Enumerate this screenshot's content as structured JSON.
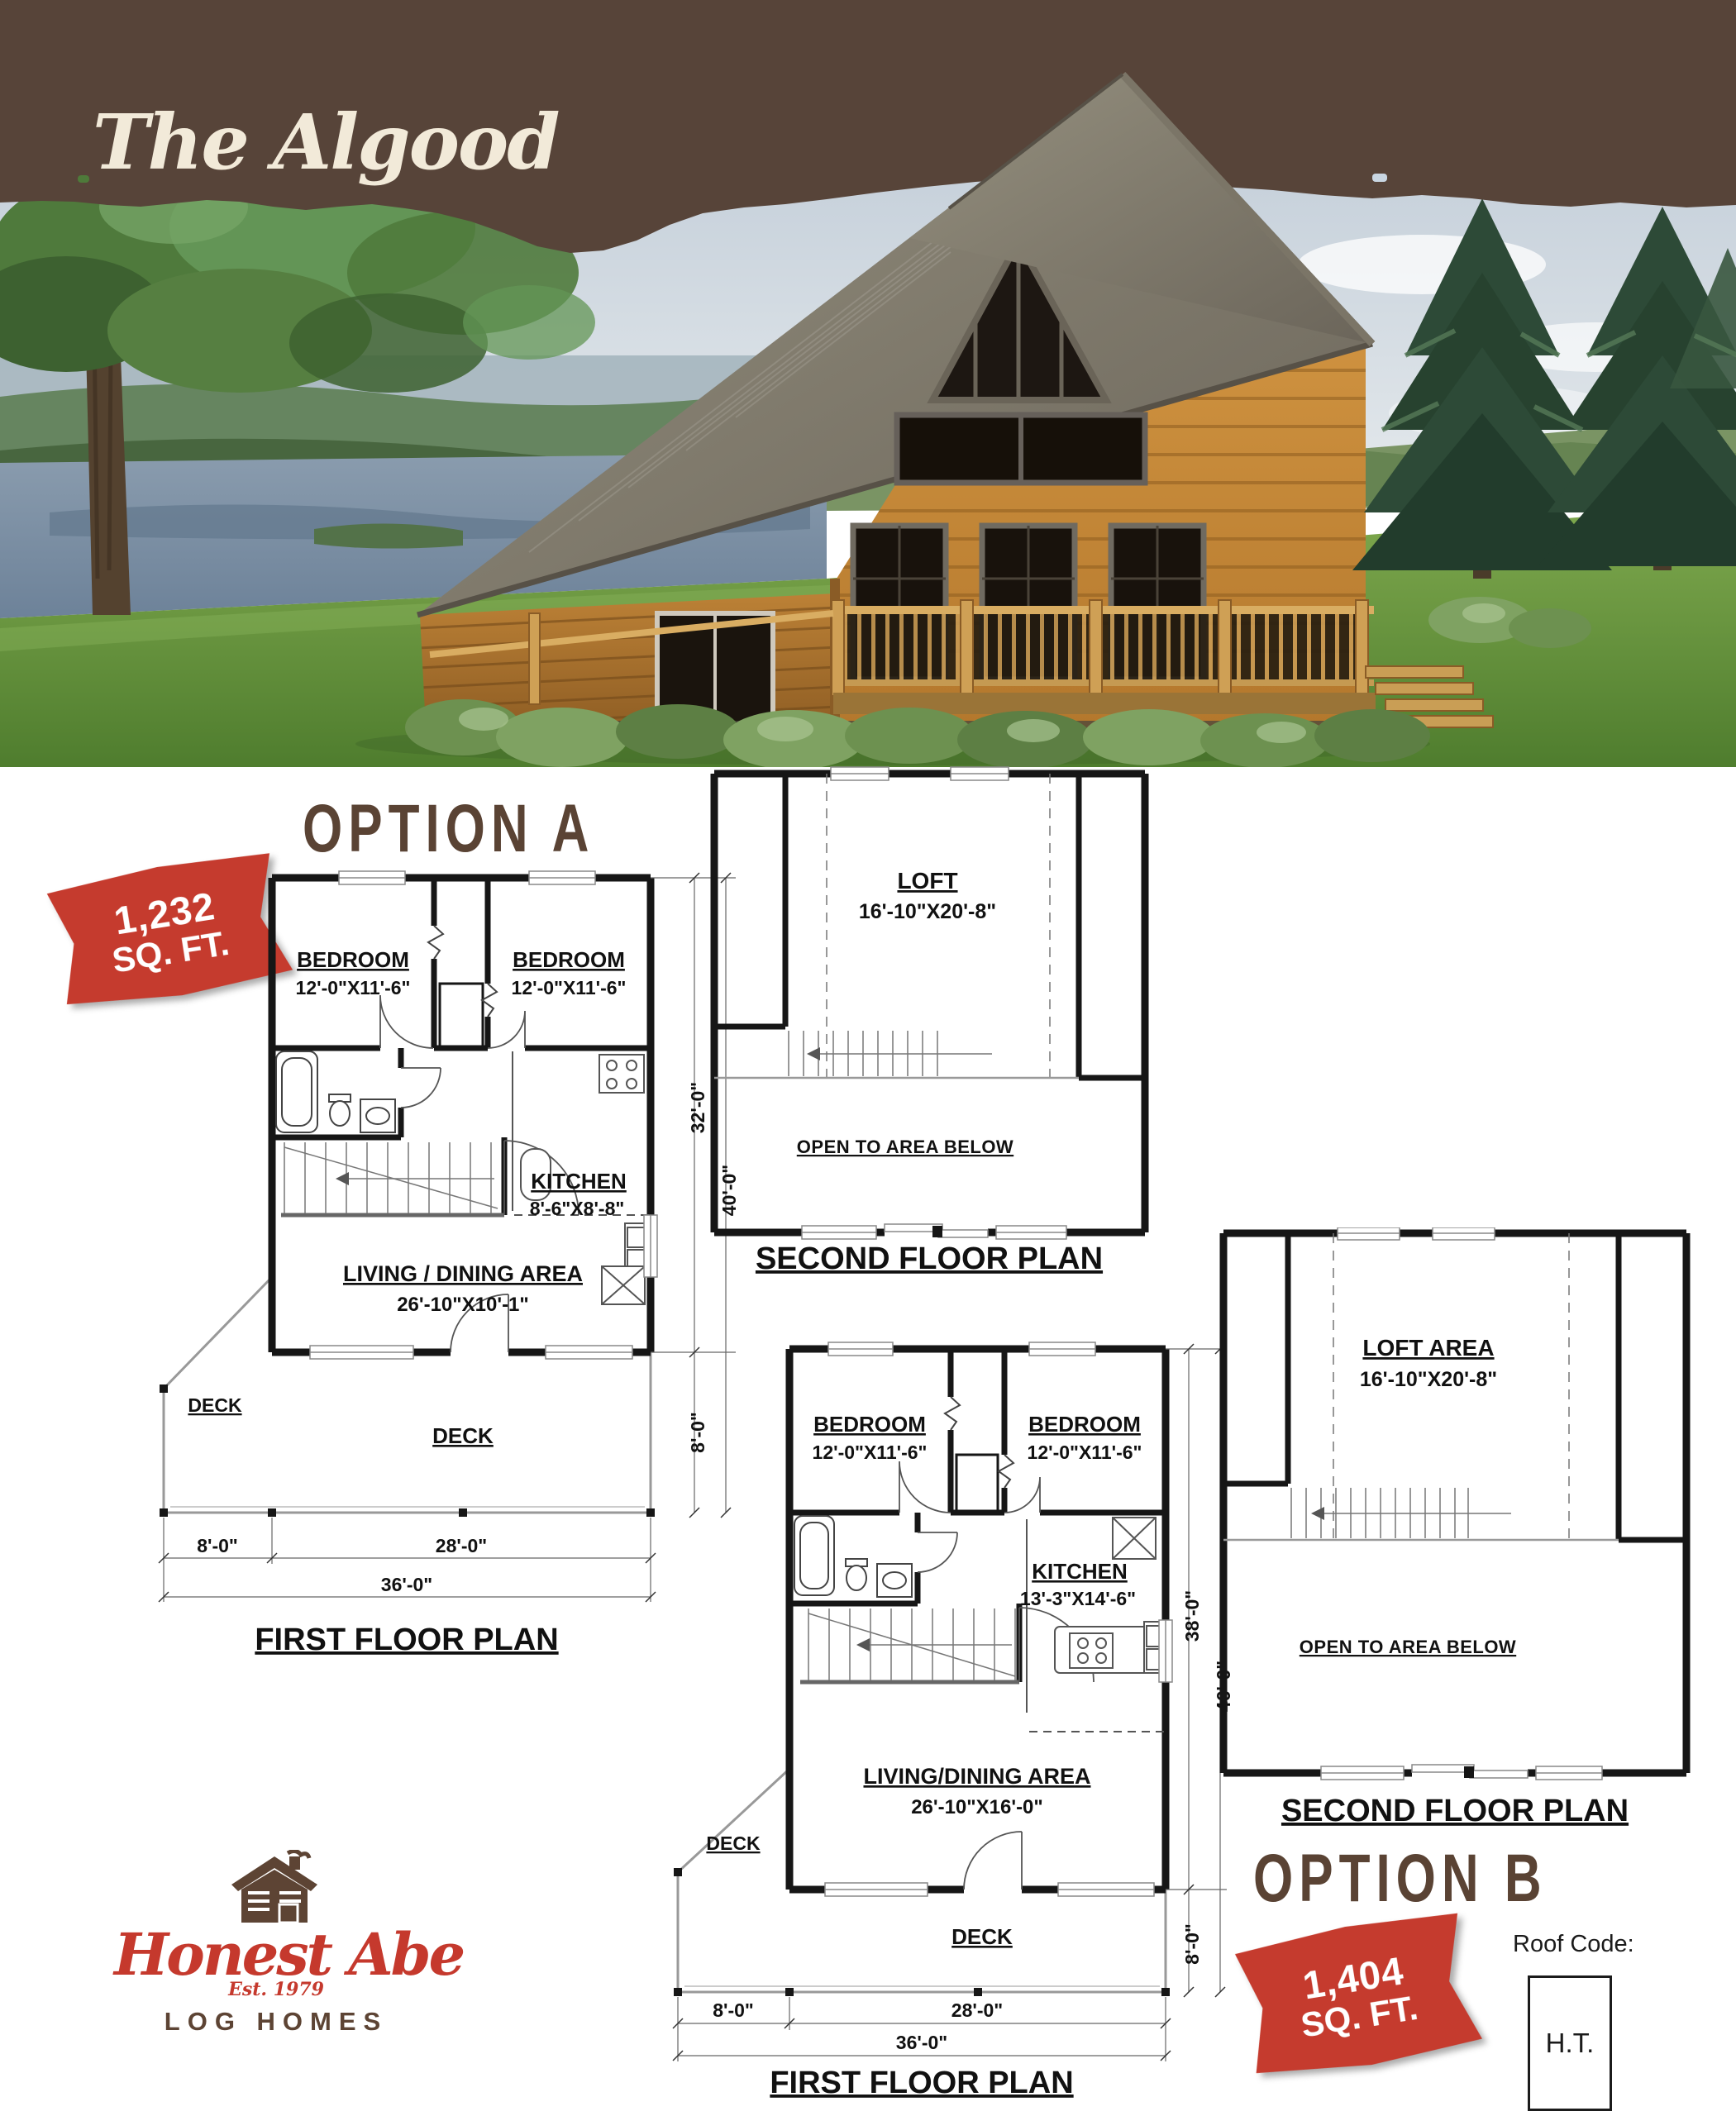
{
  "page_title": "The Algood",
  "colors": {
    "header_brown": "#574439",
    "heading_brown": "#5a4334",
    "badge_red": "#c53b2e",
    "logo_red": "#c5392d",
    "logo_brown": "#5d4434",
    "plan_line": "#161616",
    "title_cream": "#f2ead9"
  },
  "logo": {
    "name": "Honest Abe",
    "est": "Est. 1979",
    "tagline": "LOG HOMES"
  },
  "roof_code": {
    "label": "Roof Code:",
    "value": "H.T."
  },
  "options": [
    {
      "heading": "OPTION A",
      "badge": {
        "line1": "1,232",
        "line2": "SQ. FT."
      },
      "first_floor": {
        "caption": "FIRST FLOOR PLAN",
        "bedroom1": {
          "name": "BEDROOM",
          "dim": "12'-0\"X11'-6\""
        },
        "bedroom2": {
          "name": "BEDROOM",
          "dim": "12'-0\"X11'-6\""
        },
        "kitchen": {
          "name": "KITCHEN",
          "dim": "8'-6\"X8'-8\""
        },
        "living": {
          "name": "LIVING / DINING AREA",
          "dim": "26'-10\"X10'-1\""
        },
        "deck_side": "DECK",
        "deck_front": "DECK",
        "dim_depth": "32'-0\"",
        "dim_total_depth": "40'-0\"",
        "dim_deck_depth": "8'-0\"",
        "dim_deck_width": "8'-0\"",
        "dim_main_width": "28'-0\"",
        "dim_total_width": "36'-0\""
      },
      "second_floor": {
        "caption": "SECOND FLOOR PLAN",
        "loft": {
          "name": "LOFT",
          "dim": "16'-10\"X20'-8\""
        },
        "open": "OPEN TO AREA BELOW"
      }
    },
    {
      "heading": "OPTION B",
      "badge": {
        "line1": "1,404",
        "line2": "SQ. FT."
      },
      "first_floor": {
        "caption": "FIRST FLOOR PLAN",
        "bedroom1": {
          "name": "BEDROOM",
          "dim": "12'-0\"X11'-6\""
        },
        "bedroom2": {
          "name": "BEDROOM",
          "dim": "12'-0\"X11'-6\""
        },
        "kitchen": {
          "name": "KITCHEN",
          "dim": "13'-3\"X14'-6\""
        },
        "living": {
          "name": "LIVING/DINING AREA",
          "dim": "26'-10\"X16'-0\""
        },
        "deck_side": "DECK",
        "deck_front": "DECK",
        "dim_depth": "38'-0\"",
        "dim_total_depth": "46'-0\"",
        "dim_deck_depth": "8'-0\"",
        "dim_deck_width": "8'-0\"",
        "dim_main_width": "28'-0\"",
        "dim_total_width": "36'-0\""
      },
      "second_floor": {
        "caption": "SECOND FLOOR PLAN",
        "loft": {
          "name": "LOFT AREA",
          "dim": "16'-10\"X20'-8\""
        },
        "open": "OPEN TO AREA BELOW"
      }
    }
  ]
}
